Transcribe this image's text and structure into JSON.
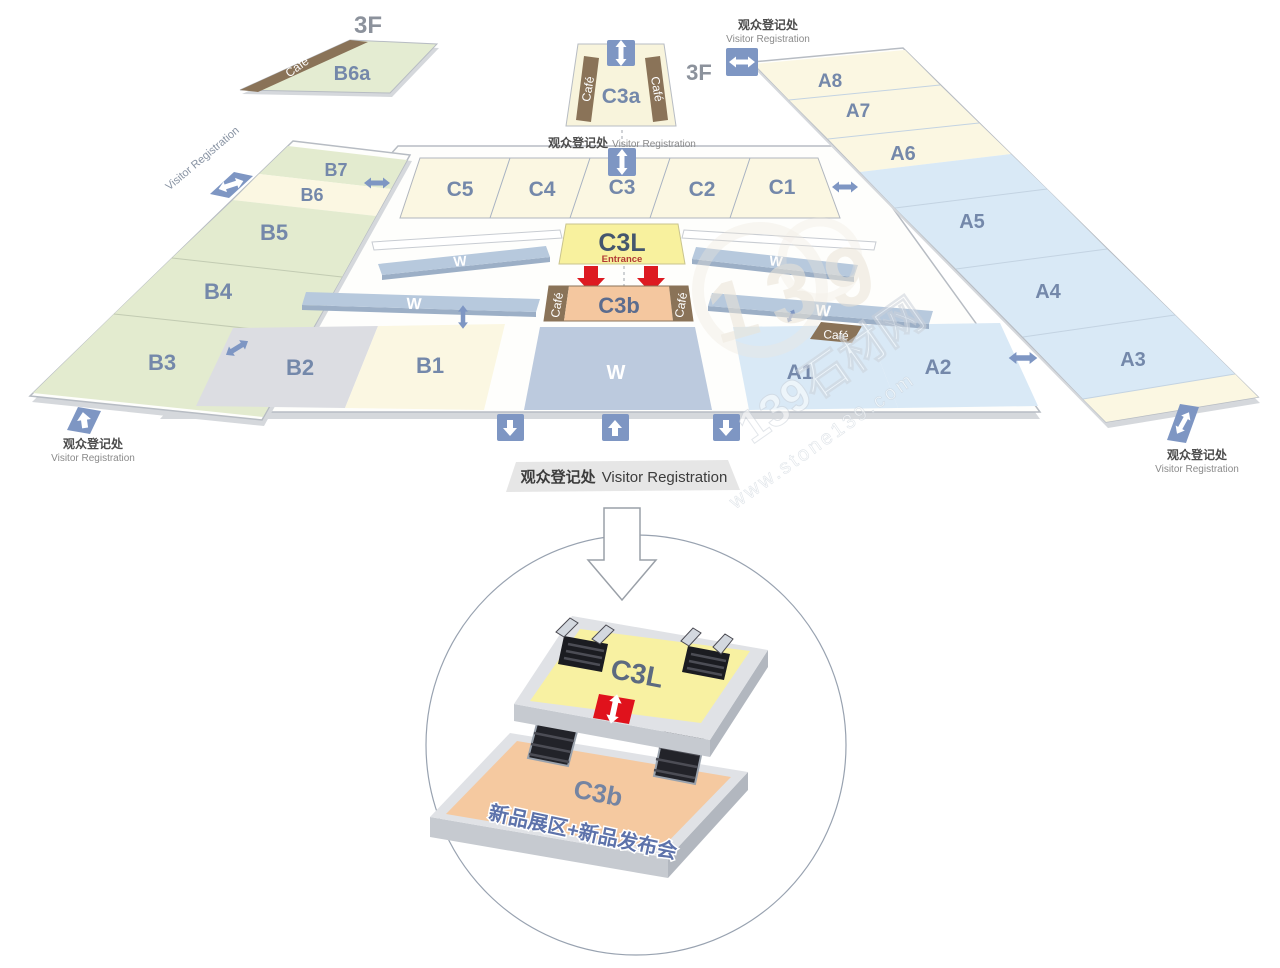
{
  "floor": {
    "level": "3F"
  },
  "labels": {
    "cafe": "Café",
    "corridor": "W",
    "entrance": "Entrance"
  },
  "registration": {
    "zh": "观众登记处",
    "en": "Visitor Registration"
  },
  "halls": {
    "b6a": "B6a",
    "b7": "B7",
    "b6": "B6",
    "b5": "B5",
    "b4": "B4",
    "b3": "B3",
    "b2": "B2",
    "b1": "B1",
    "c5": "C5",
    "c4": "C4",
    "c3": "C3",
    "c2": "C2",
    "c1": "C1",
    "c3a": "C3a",
    "c3l": "C3L",
    "c3b": "C3b",
    "a8": "A8",
    "a7": "A7",
    "a6": "A6",
    "a5": "A5",
    "a4": "A4",
    "a3": "A3",
    "a2": "A2",
    "a1": "A1"
  },
  "inset": {
    "upper_label": "C3L",
    "lower_label": "C3b",
    "lower_desc": "新品展区+新品发布会"
  },
  "watermark": {
    "digits": "139",
    "brand": "139石材网",
    "url": "www.stone139.com"
  },
  "colors": {
    "hall_green": "#e3ebcf",
    "hall_cream": "#fbf7e2",
    "hall_blue": "#d9e9f6",
    "hall_gray": "#dcdde2",
    "corridor_blue": "#b7c9dd",
    "c3l_yellow": "#f8f19e",
    "c3b_peach": "#f4c79f",
    "cafe_brown": "#8a7358",
    "arrow_blue": "#7e96c3",
    "arrow_red": "#dd1a21",
    "label_slate": "#7488aa"
  }
}
